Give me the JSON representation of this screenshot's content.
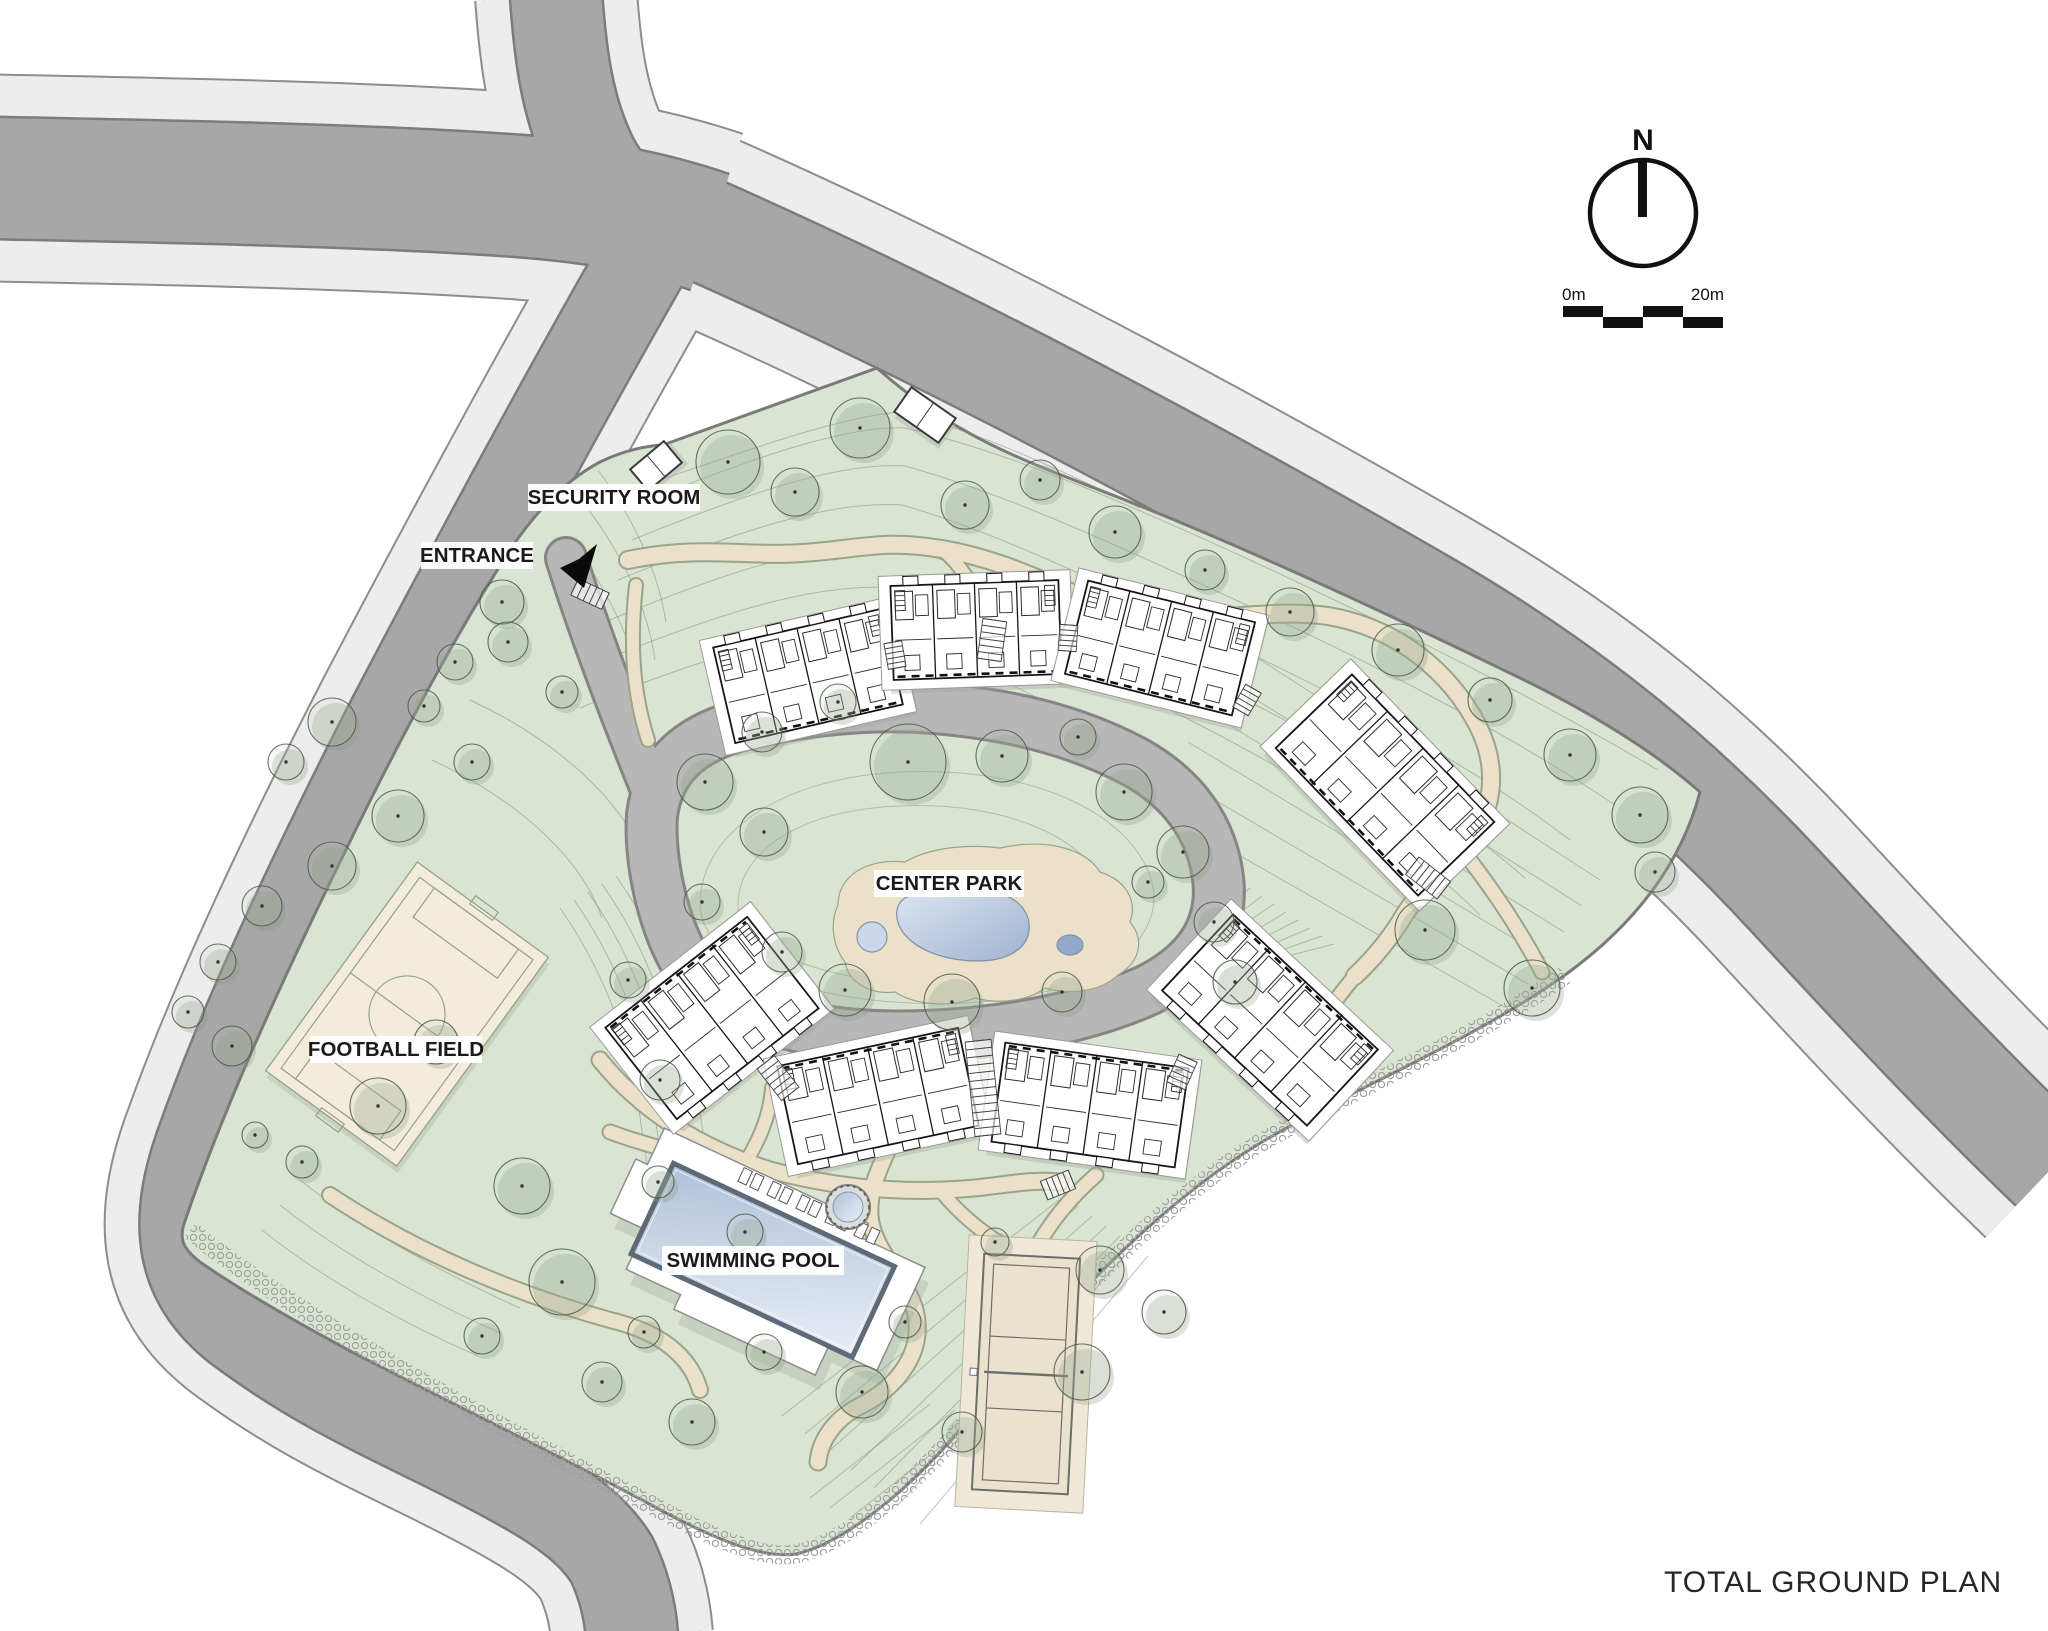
{
  "title": "TOTAL GROUND PLAN",
  "compass": {
    "north": "N"
  },
  "scale_bar": {
    "start": "0m",
    "end": "20m"
  },
  "labels": {
    "security_room": "SECURITY ROOM",
    "entrance": "ENTRANCE",
    "center_park": "CENTER PARK",
    "football_field": "FOOTBALL FIELD",
    "swimming_pool": "SWIMMING POOL"
  },
  "colors": {
    "site_green": "#d9e5d2",
    "site_edge": "#7a7a7a",
    "road_asphalt": "#a7a7a7",
    "road_casing": "#7c7c7c",
    "sidewalk": "#ededed",
    "sidewalk_casing": "#8d8d8d",
    "inner_road": "#b7b7b7",
    "inner_road_casing": "#858585",
    "path_tan": "#ebe1c9",
    "path_casing": "#9aa48b",
    "contour": "#7f8d72",
    "water_light": "#e9eef6",
    "water_dark": "#a9bbd5",
    "field_cream": "#f3ecdb",
    "court_cream": "#ebe2cd",
    "building_line": "#161616",
    "tree_line": "#4e5a49",
    "label_text": "#1a1a1a"
  }
}
